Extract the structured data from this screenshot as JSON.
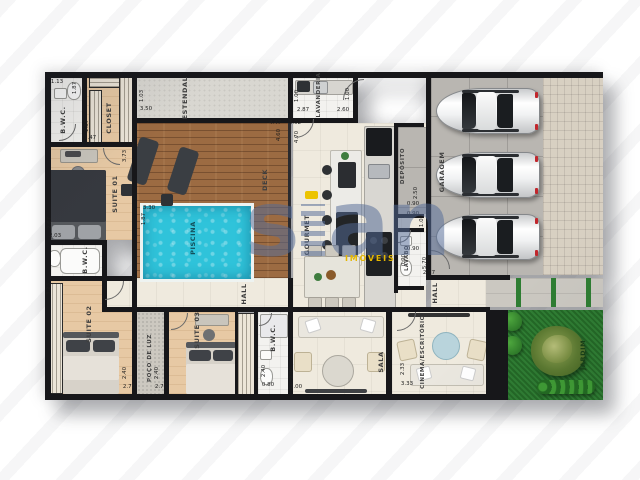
{
  "watermark": {
    "part1": "s",
    "part2": "an",
    "tagline": "IMÓVEIS",
    "color": "#556C98",
    "tagline_color": "#E5B700"
  },
  "rooms": {
    "bwc1": {
      "label": "B.W.C."
    },
    "closet": {
      "label": "CLOSET"
    },
    "suite01": {
      "label": "SUITE 01"
    },
    "bwc2": {
      "label": "B.W.C."
    },
    "suite02": {
      "label": "SUITE 02"
    },
    "poco": {
      "label": "POÇO DE LUZ"
    },
    "suite03": {
      "label": "SUITE 03"
    },
    "bwc3": {
      "label": "B.W.C."
    },
    "estendal": {
      "label": "ESTENDAL"
    },
    "lavanderia": {
      "label": "LAVANDERIA"
    },
    "deck": {
      "label": "DECK"
    },
    "piscina": {
      "label": "PISCINA"
    },
    "gourmet": {
      "label": "GOURMET"
    },
    "deposito": {
      "label": "DEPÓSITO"
    },
    "garagem": {
      "label": "GARAGEM"
    },
    "lavabo": {
      "label": "LAVABO"
    },
    "hall1": {
      "label": "HALL"
    },
    "hall2": {
      "label": "HALL"
    },
    "sala": {
      "label": "SALA"
    },
    "cinema": {
      "label": "CINEMA/ESCRITÓRIO"
    },
    "jardim": {
      "label": "JARDIM"
    }
  },
  "vehicles_in_garage": 3,
  "colors": {
    "wall": "#17171A",
    "pool_water": "#2FC3DA",
    "deck_wood": "#9C6B42",
    "suite_floor": "#E7C9A4",
    "social_floor": "#EFEADE",
    "grass": "#2F7D33",
    "car_taillight": "#C1272D"
  },
  "dimensions": [
    {
      "t": "1.13",
      "x": 12,
      "y": 10,
      "o": "h"
    },
    {
      "t": "1.87",
      "x": 30,
      "y": 16,
      "o": "v"
    },
    {
      "t": "1.87",
      "x": 42,
      "y": 54,
      "o": "v"
    },
    {
      "t": "1.47",
      "x": 45,
      "y": 66,
      "o": "h"
    },
    {
      "t": "3.73",
      "x": 80,
      "y": 84,
      "o": "v"
    },
    {
      "t": "2.67",
      "x": 5,
      "y": 151,
      "o": "v"
    },
    {
      "t": "2.03",
      "x": 10,
      "y": 164,
      "o": "h"
    },
    {
      "t": "1.03",
      "x": 97,
      "y": 24,
      "o": "v"
    },
    {
      "t": "3.50",
      "x": 101,
      "y": 37,
      "o": "h"
    },
    {
      "t": "1.00",
      "x": 252,
      "y": 24,
      "o": "v"
    },
    {
      "t": "2.87",
      "x": 258,
      "y": 38,
      "o": "h"
    },
    {
      "t": "2.60",
      "x": 298,
      "y": 38,
      "o": "h"
    },
    {
      "t": "1.00",
      "x": 303,
      "y": 22,
      "o": "v"
    },
    {
      "t": "4.47",
      "x": 230,
      "y": 51,
      "o": "h"
    },
    {
      "t": "4.60",
      "x": 234,
      "y": 63,
      "o": "v"
    },
    {
      "t": "3.02",
      "x": 250,
      "y": 51,
      "o": "h"
    },
    {
      "t": "4.70",
      "x": 252,
      "y": 65,
      "o": "v"
    },
    {
      "t": "3.30",
      "x": 104,
      "y": 136,
      "o": "h"
    },
    {
      "t": "1.87",
      "x": 99,
      "y": 147,
      "o": "v"
    },
    {
      "t": "2.50",
      "x": 371,
      "y": 121,
      "o": "v"
    },
    {
      "t": "0.90",
      "x": 368,
      "y": 132,
      "o": "h"
    },
    {
      "t": "0.90",
      "x": 368,
      "y": 142,
      "o": "h"
    },
    {
      "t": "1.00",
      "x": 377,
      "y": 149,
      "o": "v"
    },
    {
      "t": "0.90",
      "x": 368,
      "y": 177,
      "o": "h"
    },
    {
      "t": "0.90",
      "x": 359,
      "y": 188,
      "o": "v"
    },
    {
      "t": "5.70",
      "x": 380,
      "y": 191,
      "o": "v"
    },
    {
      "t": "2.77",
      "x": 384,
      "y": 201,
      "o": "h"
    },
    {
      "t": "3.23",
      "x": 4,
      "y": 217,
      "o": "v"
    },
    {
      "t": "2.40",
      "x": 80,
      "y": 301,
      "o": "v"
    },
    {
      "t": "2.78",
      "x": 84,
      "y": 315,
      "o": "h"
    },
    {
      "t": "2.40",
      "x": 112,
      "y": 301,
      "o": "v"
    },
    {
      "t": "2.77",
      "x": 116,
      "y": 315,
      "o": "h"
    },
    {
      "t": "2.40",
      "x": 219,
      "y": 299,
      "o": "v"
    },
    {
      "t": "0.80",
      "x": 223,
      "y": 313,
      "o": "h"
    },
    {
      "t": "2.90",
      "x": 247,
      "y": 301,
      "o": "v"
    },
    {
      "t": "3.00",
      "x": 251,
      "y": 315,
      "o": "h"
    },
    {
      "t": "2.33",
      "x": 358,
      "y": 297,
      "o": "v"
    },
    {
      "t": "3.33",
      "x": 362,
      "y": 312,
      "o": "h"
    }
  ]
}
